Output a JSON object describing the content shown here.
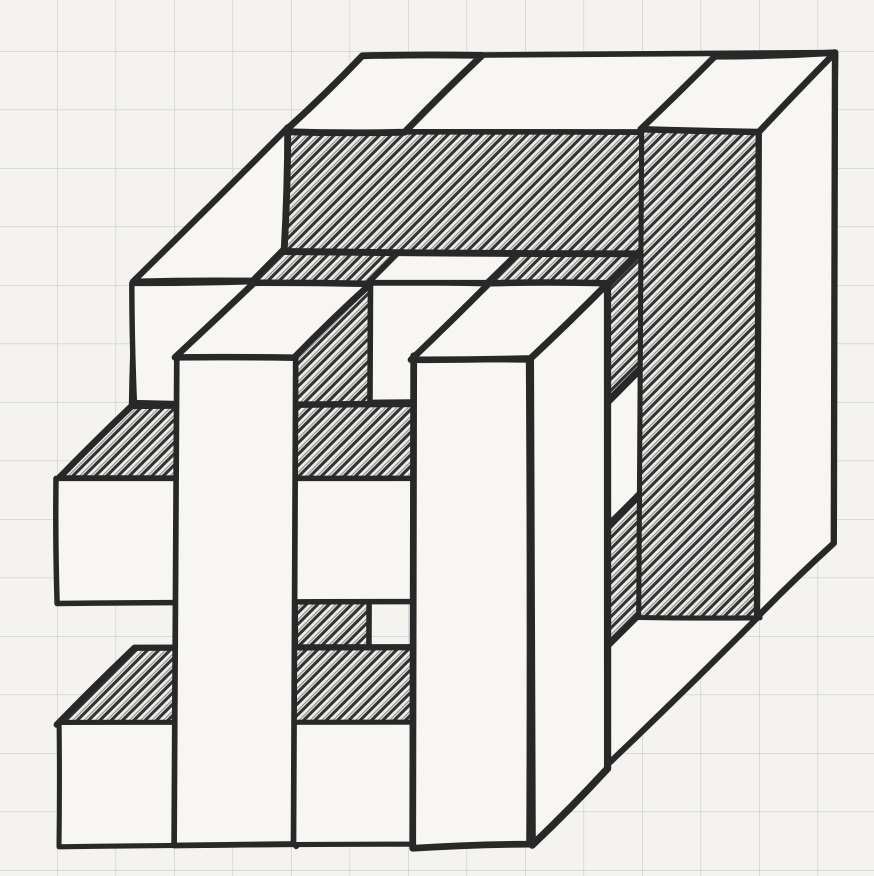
{
  "scene": {
    "title": "Hand-drawn sketch of a woven hashtag cube on graph paper",
    "object": "cube built from interlocking square bars (hashtag weave on each visible face)",
    "media": "black ink with scribbled pencil hatching",
    "view": "oblique projection, depth receding to the upper right"
  },
  "paper": {
    "width": 874,
    "height": 876,
    "background": "#f4f3f0",
    "grid_color": "#c5c7ca",
    "grid_spacing": 58.5,
    "grid_offset_x": 57,
    "grid_offset_y": 51,
    "grid_line_width": 1.3,
    "grid_opacity": 0.85
  },
  "ink": {
    "line_color": "#282828",
    "line_width": 6.2,
    "line_width_jitter": 1.2,
    "face_white": "#f7f6f3",
    "hatch_bg": "#f1f0ed",
    "hatch_color": "#323232",
    "hatch_spacing": 8,
    "hatch_line_width": 3.1,
    "vertex_jitter": 2.4,
    "edge_wobble": 1.8
  },
  "projection": {
    "origin_x": 58,
    "baseline_y": 846,
    "unit_x": 59,
    "unit_y": 61,
    "depth_dx": 38,
    "depth_dy": 38,
    "cube_units": 8
  },
  "faces": [
    {
      "name": "top-midbar-front",
      "box": [
        0,
        8,
        5.2,
        7.2,
        2,
        4
      ],
      "face": "front",
      "fill": "hatch"
    },
    {
      "name": "top-midbar-top",
      "box": [
        0,
        8,
        5.2,
        7.2,
        2,
        4
      ],
      "face": "top",
      "fill": "white"
    },
    {
      "name": "top-midbar-end",
      "box": [
        0,
        8,
        5.2,
        7.2,
        2,
        4
      ],
      "face": "right",
      "fill": "white"
    },
    {
      "name": "right-midbar-front",
      "box": [
        5.2,
        7.2,
        0,
        8,
        2,
        4
      ],
      "face": "front",
      "fill": "hatch"
    },
    {
      "name": "right-midbar-side",
      "box": [
        5.2,
        7.2,
        0,
        8,
        2,
        4
      ],
      "face": "right",
      "fill": "white"
    },
    {
      "name": "right-midbar-top",
      "box": [
        5.2,
        7.2,
        0,
        8,
        2,
        4
      ],
      "face": "top",
      "fill": "white"
    },
    {
      "name": "top-leftbar-front",
      "box": [
        0,
        2,
        6,
        8,
        2,
        6
      ],
      "face": "front",
      "fill": "white"
    },
    {
      "name": "top-leftbar-side",
      "box": [
        0,
        2,
        6,
        8,
        2,
        6
      ],
      "face": "right",
      "fill": "hatch"
    },
    {
      "name": "top-leftbar-top",
      "box": [
        0,
        2,
        6,
        8,
        2,
        6
      ],
      "face": "top",
      "fill": "white"
    },
    {
      "name": "top-midzbar-front",
      "box": [
        4,
        6,
        6,
        8,
        2,
        6
      ],
      "face": "front",
      "fill": "white"
    },
    {
      "name": "top-midzbar-side",
      "box": [
        4,
        6,
        6,
        8,
        2,
        6
      ],
      "face": "right",
      "fill": "hatch"
    },
    {
      "name": "top-midzbar-top",
      "box": [
        4,
        6,
        6,
        8,
        2,
        6
      ],
      "face": "top",
      "fill": "white"
    },
    {
      "name": "right-bottombar-front",
      "box": [
        6,
        8,
        0,
        2,
        2,
        6
      ],
      "face": "front",
      "fill": "white"
    },
    {
      "name": "right-bottombar-top",
      "box": [
        6,
        8,
        0,
        2,
        2,
        6
      ],
      "face": "top",
      "fill": "hatch"
    },
    {
      "name": "right-bottombar-side",
      "box": [
        6,
        8,
        0,
        2,
        2,
        6
      ],
      "face": "right",
      "fill": "white"
    },
    {
      "name": "right-midzbar-front",
      "box": [
        6,
        8,
        4,
        6,
        2,
        6
      ],
      "face": "front",
      "fill": "white"
    },
    {
      "name": "right-midzbar-top",
      "box": [
        6,
        8,
        4,
        6,
        2,
        6
      ],
      "face": "top",
      "fill": "hatch"
    },
    {
      "name": "right-midzbar-side",
      "box": [
        6,
        8,
        4,
        6,
        2,
        6
      ],
      "face": "right",
      "fill": "white"
    },
    {
      "name": "top-backbar-front",
      "box": [
        0,
        8,
        6,
        8,
        6,
        8
      ],
      "face": "front",
      "fill": "hatch"
    },
    {
      "name": "top-backbar-top",
      "box": [
        0,
        8,
        6,
        8,
        6,
        8
      ],
      "face": "top",
      "fill": "white"
    },
    {
      "name": "top-backbar-end",
      "box": [
        0,
        8,
        6,
        8,
        6,
        8
      ],
      "face": "right",
      "fill": "white"
    },
    {
      "name": "right-backbar-front",
      "box": [
        6,
        8,
        0,
        8,
        6,
        8
      ],
      "face": "front",
      "fill": "hatch"
    },
    {
      "name": "right-backbar-side",
      "box": [
        6,
        8,
        0,
        8,
        6,
        8
      ],
      "face": "right",
      "fill": "white"
    },
    {
      "name": "right-backbar-top",
      "box": [
        6,
        8,
        0,
        8,
        6,
        8
      ],
      "face": "top",
      "fill": "white"
    },
    {
      "name": "top-leftbar-overpass",
      "box": [
        0,
        2,
        6,
        8,
        6,
        8
      ],
      "face": "top",
      "fill": "white"
    },
    {
      "name": "front-leftbar-wall",
      "box": [
        2,
        4,
        0,
        8,
        0,
        2
      ],
      "face": "right",
      "fill": "hatch"
    },
    {
      "name": "front-armtop-top",
      "box": [
        0,
        8,
        4,
        6,
        0,
        2
      ],
      "face": "top",
      "fill": "hatch"
    },
    {
      "name": "front-armtop-front",
      "box": [
        0,
        8,
        4,
        6,
        0,
        2
      ],
      "face": "front",
      "fill": "white"
    },
    {
      "name": "front-armtop-end",
      "box": [
        0,
        8,
        4,
        6,
        0,
        2
      ],
      "face": "right",
      "fill": "white"
    },
    {
      "name": "front-armbottom-top",
      "box": [
        0,
        8,
        0,
        2,
        0,
        2
      ],
      "face": "top",
      "fill": "hatch"
    },
    {
      "name": "front-armbottom-front",
      "box": [
        0,
        8,
        0,
        2,
        0,
        2
      ],
      "face": "front",
      "fill": "white"
    },
    {
      "name": "front-armbottom-end",
      "box": [
        0,
        8,
        0,
        2,
        0,
        2
      ],
      "face": "right",
      "fill": "white"
    },
    {
      "name": "front-vbar-left-front",
      "box": [
        2,
        4,
        0,
        8,
        0,
        2
      ],
      "face": "front",
      "fill": "white"
    },
    {
      "name": "front-vbar-left-top",
      "box": [
        2,
        4,
        0,
        8,
        0,
        2
      ],
      "face": "top",
      "fill": "white"
    },
    {
      "name": "front-vbar-right-side",
      "box": [
        6,
        8,
        0,
        8,
        0,
        2
      ],
      "face": "right",
      "fill": "white"
    },
    {
      "name": "front-vbar-right-front",
      "box": [
        6,
        8,
        0,
        8,
        0,
        2
      ],
      "face": "front",
      "fill": "white"
    },
    {
      "name": "front-vbar-right-top",
      "box": [
        6,
        8,
        0,
        8,
        0,
        2
      ],
      "face": "top",
      "fill": "white"
    }
  ]
}
